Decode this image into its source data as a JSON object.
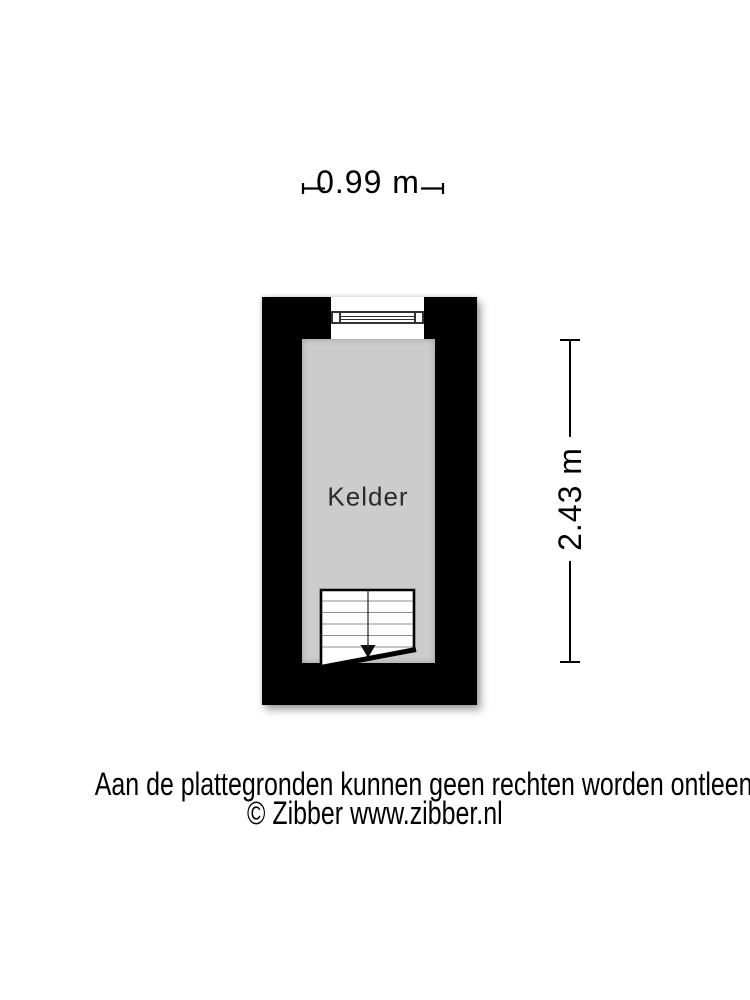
{
  "floorplan": {
    "room": {
      "label": "Kelder"
    },
    "dimensions": {
      "width_label": "0.99 m",
      "height_label": "2.43 m"
    },
    "colors": {
      "wall": "#000000",
      "floor": "#cccccc",
      "window_frame": "#333333",
      "background": "#ffffff"
    }
  },
  "footer": {
    "disclaimer": "Aan de plattegronden kunnen geen rechten worden ontleend",
    "copyright": "© Zibber www.zibber.nl"
  }
}
